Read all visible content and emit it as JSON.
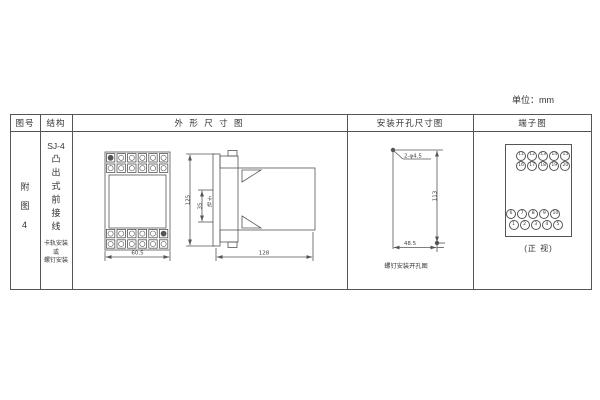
{
  "unit_label": "单位：mm",
  "table": {
    "headers": [
      "图号",
      "结构",
      "外 形 尺 寸 图",
      "安装开孔尺寸图",
      "端子图"
    ]
  },
  "figure": {
    "number": "附图4"
  },
  "structure": {
    "model": "SJ-4",
    "type": "凸出式前接线",
    "mount_lines": [
      "卡轨安装",
      "或",
      "螺钉安装"
    ]
  },
  "outline": {
    "front_width": "60.5",
    "height": "125",
    "rail_width": "35",
    "rail_label": "卡轨",
    "depth": "128"
  },
  "mounting": {
    "holes": "2-φ4.5",
    "v_spacing": "113",
    "h_spacing": "48.5",
    "caption": "螺钉安装开孔图"
  },
  "terminals": {
    "top_rows": [
      [
        "11",
        "12",
        "13",
        "14",
        "15"
      ],
      [
        "16",
        "17",
        "18",
        "19",
        "20"
      ]
    ],
    "bottom_rows": [
      [
        "6",
        "7",
        "8",
        "9",
        "10"
      ],
      [
        "1",
        "2",
        "3",
        "4",
        "5"
      ]
    ],
    "caption": "(正 视)"
  },
  "colors": {
    "line": "#555555",
    "text": "#333333",
    "background": "#ffffff"
  }
}
